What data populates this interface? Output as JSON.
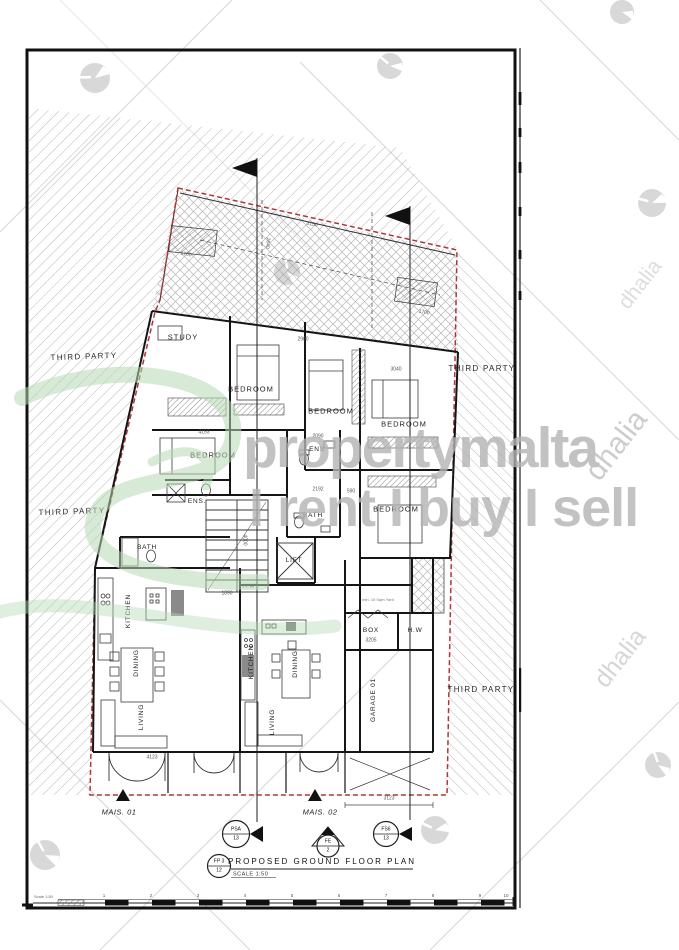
{
  "watermarks": {
    "brand": "propertymalta",
    "tagline": "I rent I buy I sell",
    "agency": "dhalia"
  },
  "sheet": {
    "third_party": [
      "THIRD PARTY",
      "THIRD PARTY",
      "THIRD PARTY",
      "THIRD PARTY"
    ],
    "rooms": [
      "STUDY",
      "BEDROOM",
      "BEDROOM",
      "BEDROOM",
      "BEDROOM",
      "BEDROOM",
      "ENS",
      "ENS.",
      "BATH",
      "BATH",
      "LIFT",
      "H.W",
      "BOX",
      "H.W",
      "KITCHEN",
      "DINING",
      "LIVING",
      "KITCHEN",
      "DINING",
      "LIVING",
      "GARAGE 01",
      "min. 10 Sqm Yard"
    ],
    "dims": [
      "3150",
      "2640",
      "1700",
      "1700",
      "3040",
      "2980",
      "4193",
      "2192",
      "4000",
      "1890",
      "1700",
      "4123",
      "3123",
      "3205",
      "2090",
      "590"
    ],
    "units": {
      "mais_01": "MAIS. 01",
      "mais_02": "MAIS. 02"
    },
    "markers": {
      "section_a": {
        "top": "PSA",
        "bottom": "13"
      },
      "section_b": {
        "top": "FS6",
        "bottom": "13"
      },
      "entrance": {
        "top": "FE",
        "bottom": "2"
      },
      "plan_ref": {
        "top": "FP 3",
        "bottom": "12"
      }
    },
    "title": {
      "text": "PROPOSED GROUND FLOOR PLAN",
      "scale": "SCALE 1:50"
    },
    "scale_bar": {
      "label": "Scale 1:50",
      "ticks": [
        "1",
        "2",
        "3",
        "4",
        "5",
        "6",
        "7",
        "8",
        "9",
        "10"
      ]
    },
    "boundary_color": "#b03535"
  }
}
